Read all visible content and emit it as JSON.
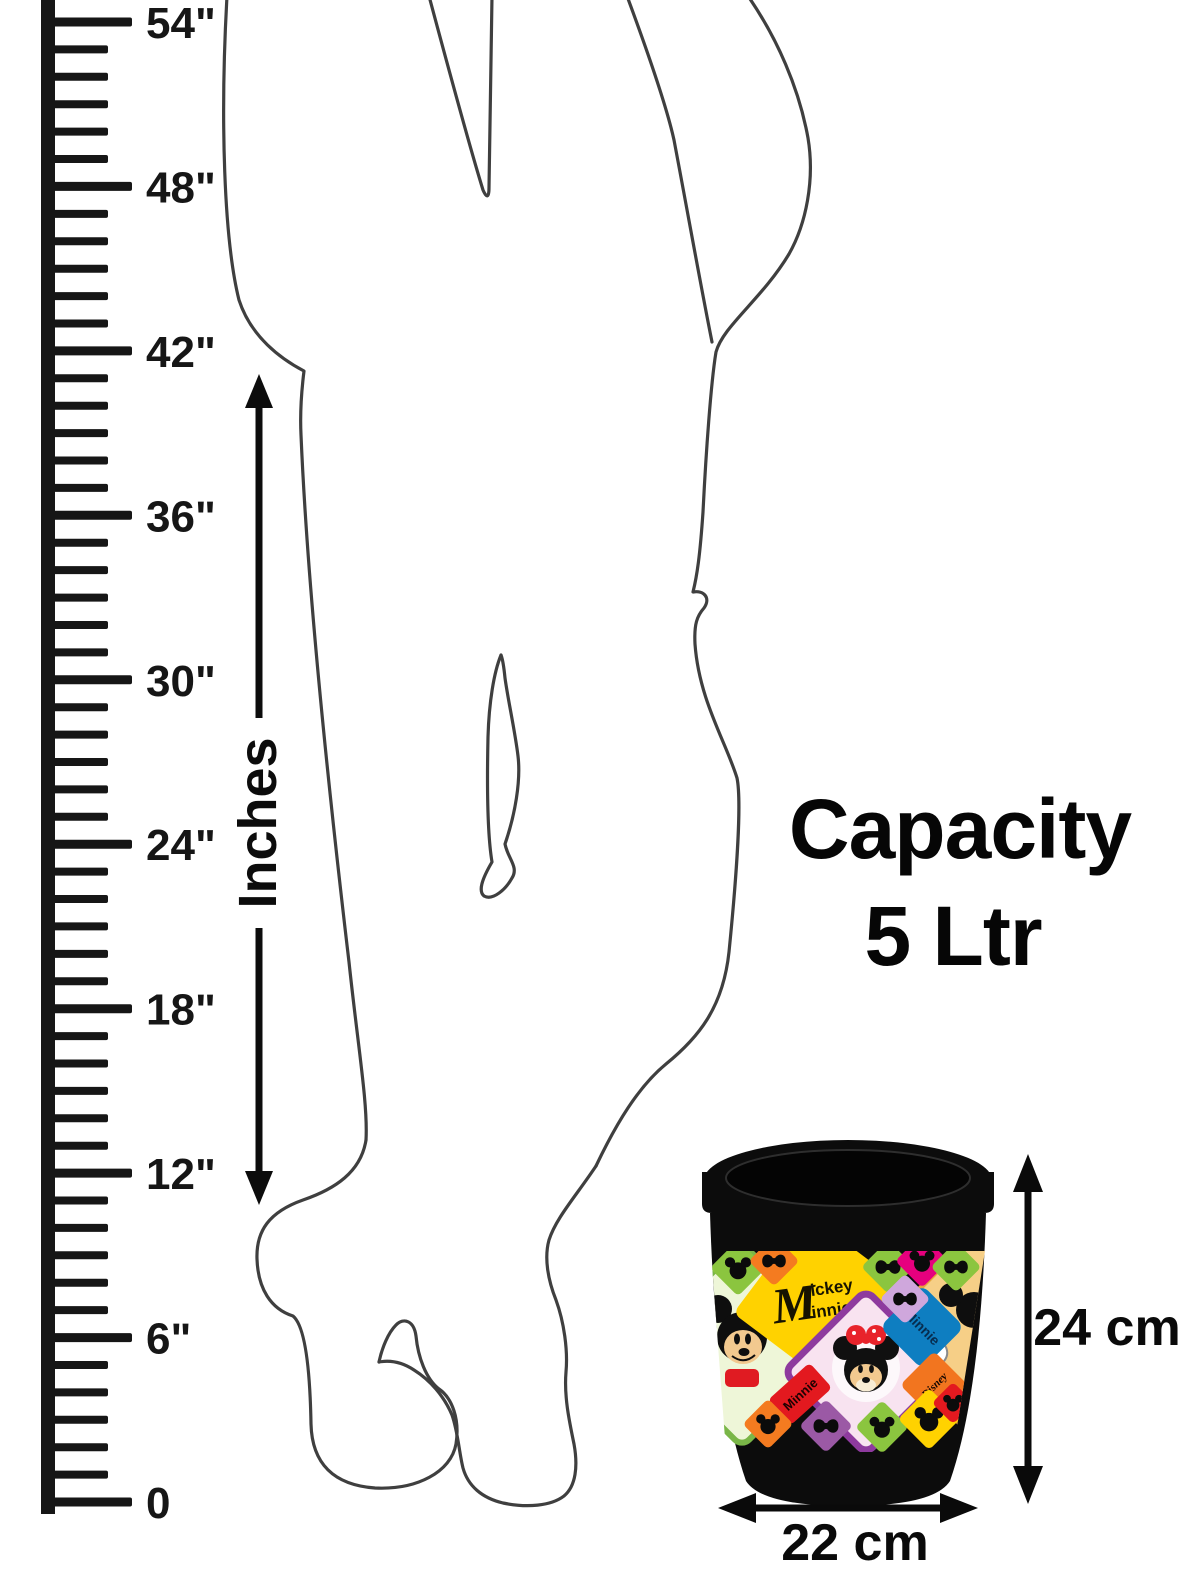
{
  "ruler": {
    "unit_label": "Inches",
    "max_value": 54,
    "major_step": 6,
    "labels": [
      {
        "value": 54,
        "text": "54\""
      },
      {
        "value": 48,
        "text": "48\""
      },
      {
        "value": 42,
        "text": "42\""
      },
      {
        "value": 36,
        "text": "36\""
      },
      {
        "value": 30,
        "text": "30\""
      },
      {
        "value": 24,
        "text": "24\""
      },
      {
        "value": 18,
        "text": "18\""
      },
      {
        "value": 12,
        "text": "12\""
      },
      {
        "value": 6,
        "text": "6\""
      },
      {
        "value": 0,
        "text": "0"
      }
    ],
    "color": "#161616"
  },
  "capacity": {
    "line1": "Capacity",
    "line2": "5 Ltr"
  },
  "dimensions": {
    "height": "24 cm",
    "width": "22 cm"
  },
  "product": {
    "band_texts": {
      "mickey_minnie": {
        "initial": "M",
        "top": "ickey",
        "bottom": "innie"
      },
      "minnie_blue": "Minnie",
      "minnie_red": "Minnie",
      "disney": "Disney"
    },
    "colors": {
      "bucket": "#0c0c0c",
      "yellow": "#ffd200",
      "orange": "#f47b20",
      "green": "#8bc53f",
      "magenta": "#e6007e",
      "red": "#e3191f",
      "blue": "#0e7ec1",
      "lavender": "#cfa7dc",
      "purple": "#9b59a5",
      "pale_green": "#eef6d8",
      "pale_yellow": "#f6cf87",
      "pink": "#f8e3f0",
      "purple_border": "#8e3a9e",
      "tan": "#f2c98f"
    },
    "band_cells": [
      {
        "x": 738,
        "y": 1268,
        "d": 20,
        "color": "#8bc53f",
        "icon": "mickey"
      },
      {
        "x": 774,
        "y": 1261,
        "d": 18,
        "color": "#f47b20",
        "icon": "bow"
      },
      {
        "x": 888,
        "y": 1267,
        "d": 19,
        "color": "#8bc53f",
        "icon": "bow"
      },
      {
        "x": 922,
        "y": 1261,
        "d": 19,
        "color": "#e6007e",
        "icon": "mickey"
      },
      {
        "x": 956,
        "y": 1267,
        "d": 18,
        "color": "#8bc53f",
        "icon": "bow"
      },
      {
        "x": 905,
        "y": 1299,
        "d": 18,
        "color": "#cfa7dc",
        "icon": "bow"
      },
      {
        "x": 768,
        "y": 1424,
        "d": 18,
        "color": "#f47b20",
        "icon": "mickey"
      },
      {
        "x": 826,
        "y": 1426,
        "d": 19,
        "color": "#9b59a5",
        "icon": "bow"
      },
      {
        "x": 882,
        "y": 1427,
        "d": 19,
        "color": "#8bc53f",
        "icon": "mickey"
      },
      {
        "x": 929,
        "y": 1419,
        "d": 22,
        "color": "#ffd200",
        "icon": "mickey"
      },
      {
        "x": 953,
        "y": 1403,
        "d": 15,
        "color": "#e3191f",
        "icon": "mickey"
      }
    ]
  }
}
